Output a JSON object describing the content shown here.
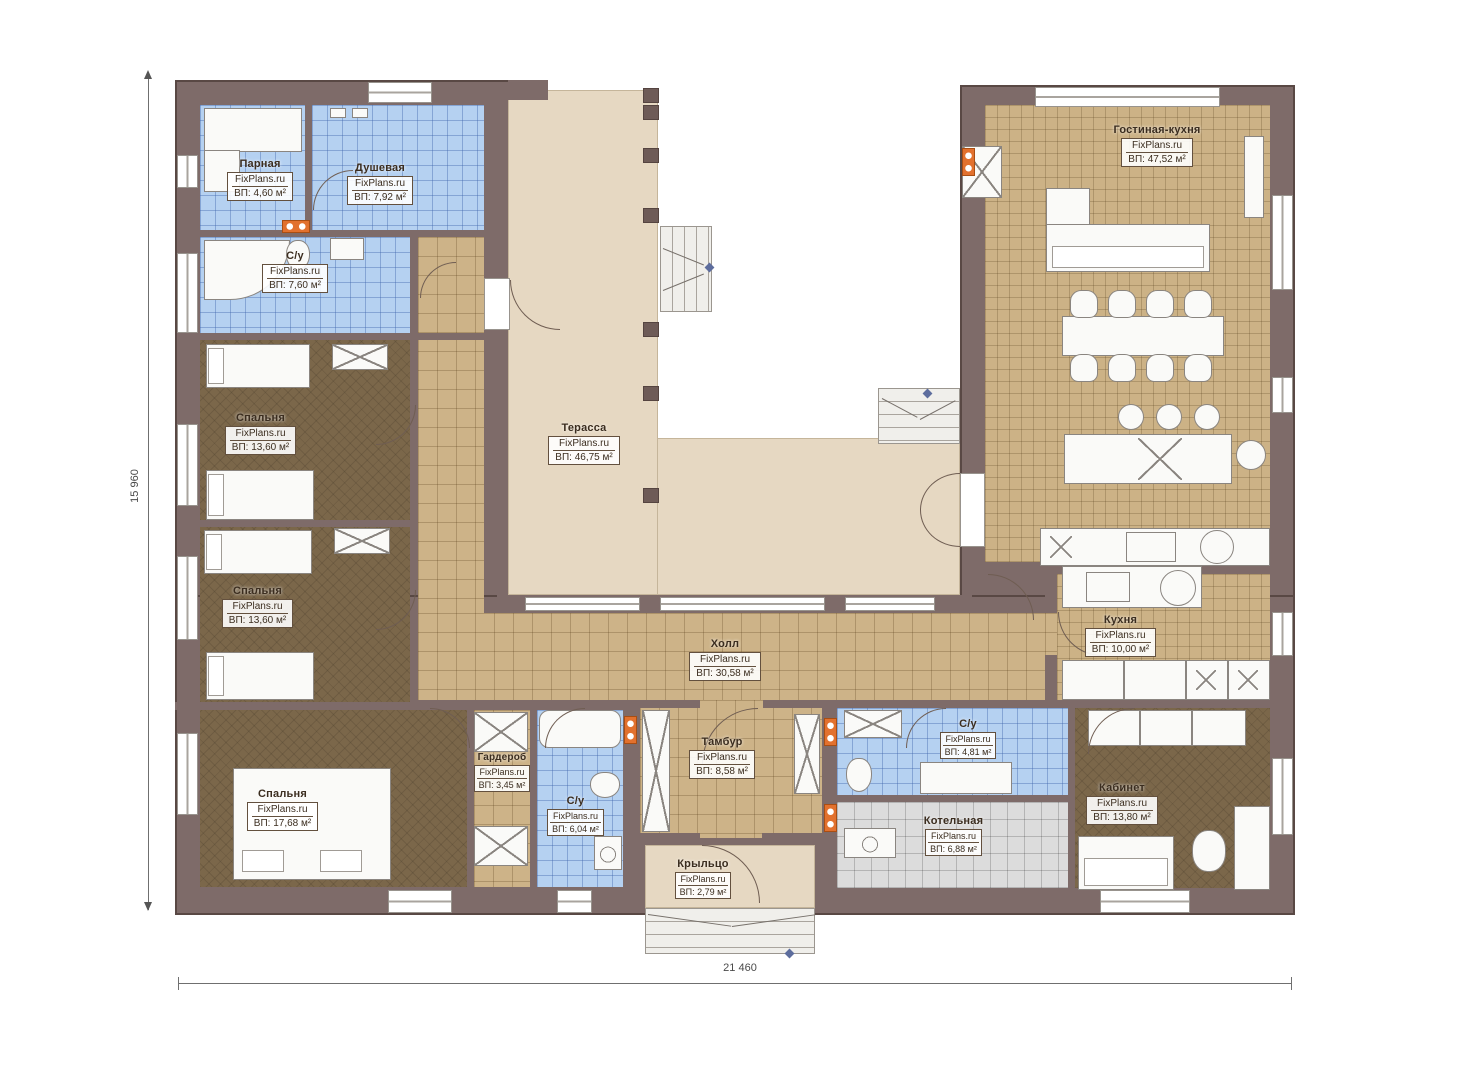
{
  "plan": {
    "watermark": "FixPlans.ru",
    "rooms": {
      "parnaya": {
        "name": "Парная",
        "area": "ВП: 4,60 м²"
      },
      "dushevaya": {
        "name": "Душевая",
        "area": "ВП: 7,92 м²"
      },
      "su1": {
        "name": "С/у",
        "area": "ВП: 7,60 м²"
      },
      "bedroom1": {
        "name": "Спальня",
        "area": "ВП: 13,60 м²"
      },
      "bedroom2": {
        "name": "Спальня",
        "area": "ВП: 13,60 м²"
      },
      "bedroom3": {
        "name": "Спальня",
        "area": "ВП: 17,68 м²"
      },
      "terrace": {
        "name": "Терасса",
        "area": "ВП: 46,75 м²"
      },
      "hall": {
        "name": "Холл",
        "area": "ВП: 30,58 м²"
      },
      "living": {
        "name": "Гостиная-кухня",
        "area": "ВП: 47,52 м²"
      },
      "kitchen": {
        "name": "Кухня",
        "area": "ВП: 10,00 м²"
      },
      "wardrobe": {
        "name": "Гардероб",
        "area": "ВП: 3,45 м²"
      },
      "su2": {
        "name": "С/у",
        "area": "ВП: 6,04 м²"
      },
      "tambur": {
        "name": "Тамбур",
        "area": "ВП: 8,58 м²"
      },
      "su3": {
        "name": "С/у",
        "area": "ВП: 4,81 м²"
      },
      "boiler": {
        "name": "Котельная",
        "area": "ВП: 6,88 м²"
      },
      "office": {
        "name": "Кабинет",
        "area": "ВП: 13,80 м²"
      },
      "porch": {
        "name": "Крыльцо",
        "area": "ВП: 2,79 м²"
      }
    },
    "dimensions": {
      "height_label": "15 960",
      "width_label": "21 460"
    },
    "colors": {
      "wall": "#7e6b69",
      "terrace_beige": "#e6d8c2",
      "tile_tan": "#cdb388",
      "tile_blue": "#b5d1f1",
      "carpet_brown": "#7b674a",
      "tile_gray": "#dcdcdc",
      "vent_orange": "#e2712e",
      "marker_blue": "#5d6d9d"
    }
  }
}
